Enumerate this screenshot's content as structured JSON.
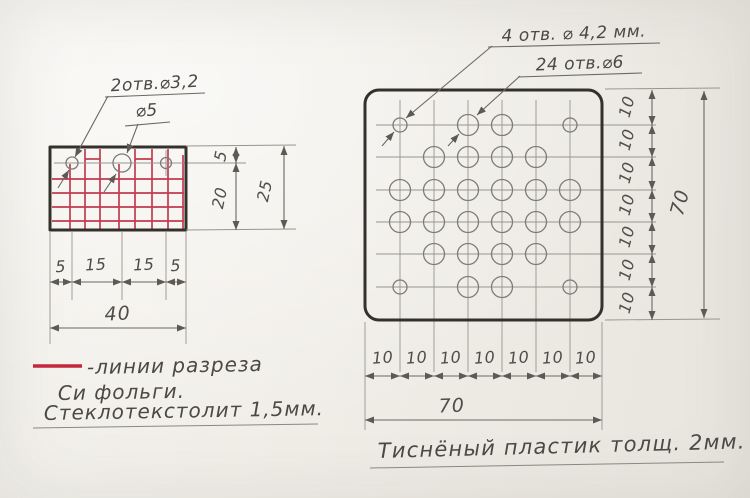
{
  "left_drawing": {
    "labels": {
      "holes2": "2отв.⌀3,2",
      "hole5": "⌀5"
    },
    "dims": {
      "gap5": "5",
      "h20": "20",
      "h25": "25",
      "chain": [
        "5",
        "15",
        "15",
        "5"
      ],
      "width40": "40"
    },
    "legend": {
      "cut_lines": "-линии разреза",
      "cut_lines2": "Си фольги.",
      "material": "Стеклотекстолит 1,5мм."
    }
  },
  "right_drawing": {
    "labels": {
      "holes4": "4 отв. ⌀ 4,2 мм.",
      "holes24": "24 отв.⌀6"
    },
    "dims": {
      "step": "10",
      "total": "70"
    },
    "note": "Тиснёный пластик толщ. 2мм."
  },
  "colors": {
    "red_cut": "#c23b4e",
    "pencil": "#8a8784",
    "ink": "#4b4845",
    "plate_outline": "#34312c",
    "paper": "#f0ede7"
  }
}
